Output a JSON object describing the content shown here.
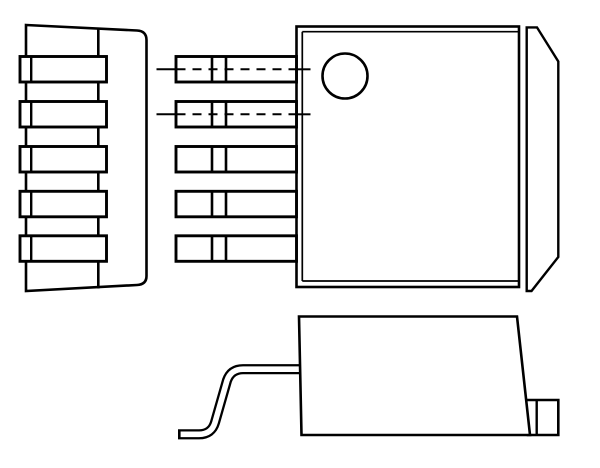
{
  "page": {
    "background": "#ffffff"
  },
  "diagram": {
    "kind": "technical-line-drawing",
    "subject": "Three-view mechanical outline drawing of a 5-lead surface-mount power package (D2PAK / TO-263 style) with mounting tab and pin-1 indicator circle",
    "lead_count": 5,
    "canvas": {
      "width": 600,
      "height": 468
    },
    "style": {
      "stroke": "#000000",
      "stroke_width": 2.6,
      "fill": "none",
      "background": "#ffffff"
    },
    "views": [
      {
        "name": "top-view",
        "shapes": [
          {
            "name": "package-body-outline",
            "type": "rect",
            "attrs": {
              "x": 296.5,
              "y": 26.5,
              "width": 222.5,
              "height": 260.5,
              "fill": "#ffffff",
              "stroke-width": 2.6
            }
          },
          {
            "name": "mold-line-left",
            "type": "line",
            "attrs": {
              "x1": 302.3,
              "y1": 31.7,
              "x2": 302.3,
              "y2": 281,
              "stroke-width": 1.7
            }
          },
          {
            "name": "mold-line-top",
            "type": "line",
            "attrs": {
              "x1": 302.3,
              "y1": 31.7,
              "x2": 519,
              "y2": 31.7,
              "stroke-width": 1.7
            }
          },
          {
            "name": "mold-line-bottom",
            "type": "line",
            "attrs": {
              "x1": 302.3,
              "y1": 281,
              "x2": 519,
              "y2": 281,
              "stroke-width": 1.7
            }
          },
          {
            "name": "mounting-tab-outline",
            "type": "path",
            "attrs": {
              "d": "M 526.7 27.4 L 537 27.4 L 558.3 61.5 L 558.3 257 L 531.5 291 L 526.7 291 Z",
              "fill": "#ffffff",
              "stroke-width": 2.4
            }
          },
          {
            "name": "pin1-indicator-circle",
            "type": "circle",
            "attrs": {
              "cx": 345,
              "cy": 76,
              "r": 22.5,
              "fill": "none",
              "stroke-width": 2.6
            }
          }
        ]
      },
      {
        "name": "lead-detail-view",
        "shapes": [
          {
            "name": "lead-1-outline",
            "type": "rect",
            "attrs": {
              "x": 176,
              "y": 56.5,
              "width": 120.5,
              "height": 25.5,
              "fill": "#ffffff",
              "stroke-width": 2.9
            }
          },
          {
            "name": "lead-1-bend-line-a",
            "type": "line",
            "attrs": {
              "x1": 212,
              "y1": 56.5,
              "x2": 212,
              "y2": 82,
              "stroke-width": 2.6
            }
          },
          {
            "name": "lead-1-bend-line-b",
            "type": "line",
            "attrs": {
              "x1": 226,
              "y1": 56.5,
              "x2": 226,
              "y2": 82,
              "stroke-width": 2.6
            }
          },
          {
            "name": "lead-2-outline",
            "type": "rect",
            "attrs": {
              "x": 176,
              "y": 101.5,
              "width": 120.5,
              "height": 25.5,
              "fill": "#ffffff",
              "stroke-width": 2.9
            }
          },
          {
            "name": "lead-2-bend-line-a",
            "type": "line",
            "attrs": {
              "x1": 212,
              "y1": 101.5,
              "x2": 212,
              "y2": 127,
              "stroke-width": 2.6
            }
          },
          {
            "name": "lead-2-bend-line-b",
            "type": "line",
            "attrs": {
              "x1": 226,
              "y1": 101.5,
              "x2": 226,
              "y2": 127,
              "stroke-width": 2.6
            }
          },
          {
            "name": "lead-3-outline",
            "type": "rect",
            "attrs": {
              "x": 176,
              "y": 146.5,
              "width": 120.5,
              "height": 25.5,
              "fill": "#ffffff",
              "stroke-width": 2.9
            }
          },
          {
            "name": "lead-3-bend-line-a",
            "type": "line",
            "attrs": {
              "x1": 212,
              "y1": 146.5,
              "x2": 212,
              "y2": 172,
              "stroke-width": 2.6
            }
          },
          {
            "name": "lead-3-bend-line-b",
            "type": "line",
            "attrs": {
              "x1": 226,
              "y1": 146.5,
              "x2": 226,
              "y2": 172,
              "stroke-width": 2.6
            }
          },
          {
            "name": "lead-4-outline",
            "type": "rect",
            "attrs": {
              "x": 176,
              "y": 191.3,
              "width": 120.5,
              "height": 25.5,
              "fill": "#ffffff",
              "stroke-width": 2.9
            }
          },
          {
            "name": "lead-4-bend-line-a",
            "type": "line",
            "attrs": {
              "x1": 212,
              "y1": 191.3,
              "x2": 212,
              "y2": 216.8,
              "stroke-width": 2.6
            }
          },
          {
            "name": "lead-4-bend-line-b",
            "type": "line",
            "attrs": {
              "x1": 226,
              "y1": 191.3,
              "x2": 226,
              "y2": 216.8,
              "stroke-width": 2.6
            }
          },
          {
            "name": "lead-5-outline",
            "type": "rect",
            "attrs": {
              "x": 176,
              "y": 235.8,
              "width": 120.5,
              "height": 25.5,
              "fill": "#ffffff",
              "stroke-width": 2.9
            }
          },
          {
            "name": "lead-5-bend-line-a",
            "type": "line",
            "attrs": {
              "x1": 212,
              "y1": 235.8,
              "x2": 212,
              "y2": 261.3,
              "stroke-width": 2.6
            }
          },
          {
            "name": "lead-5-bend-line-b",
            "type": "line",
            "attrs": {
              "x1": 226,
              "y1": 235.8,
              "x2": 226,
              "y2": 261.3,
              "stroke-width": 2.6
            }
          },
          {
            "name": "lead-1-centerline-solid-left",
            "type": "line",
            "attrs": {
              "x1": 156.5,
              "y1": 69.3,
              "x2": 176.5,
              "y2": 69.3,
              "stroke-width": 2
            }
          },
          {
            "name": "lead-1-centerline-dashed",
            "type": "line",
            "attrs": {
              "x1": 176.5,
              "y1": 69.3,
              "x2": 296,
              "y2": 69.3,
              "stroke-width": 2,
              "stroke-dasharray": "9 7"
            }
          },
          {
            "name": "lead-1-centerline-solid-right",
            "type": "line",
            "attrs": {
              "x1": 296,
              "y1": 69.3,
              "x2": 310.5,
              "y2": 69.3,
              "stroke-width": 2
            }
          },
          {
            "name": "lead-2-centerline-solid-left",
            "type": "line",
            "attrs": {
              "x1": 156.5,
              "y1": 114.3,
              "x2": 176.5,
              "y2": 114.3,
              "stroke-width": 2
            }
          },
          {
            "name": "lead-2-centerline-dashed",
            "type": "line",
            "attrs": {
              "x1": 176.5,
              "y1": 114.3,
              "x2": 296,
              "y2": 114.3,
              "stroke-width": 2,
              "stroke-dasharray": "9 7"
            }
          },
          {
            "name": "lead-2-centerline-solid-right",
            "type": "line",
            "attrs": {
              "x1": 296,
              "y1": 114.3,
              "x2": 310.5,
              "y2": 114.3,
              "stroke-width": 2
            }
          }
        ]
      },
      {
        "name": "front-view",
        "shapes": [
          {
            "name": "package-body-outline",
            "type": "path",
            "attrs": {
              "d": "M 26 25 L 137 30.5 Q 146.5 31 146.5 40 L 146.5 276 Q 146.5 284.5 137 285 L 26 291 Z",
              "fill": "#ffffff",
              "stroke-width": 2.6
            }
          },
          {
            "name": "body-edge-line",
            "type": "line",
            "attrs": {
              "x1": 98.3,
              "y1": 28.5,
              "x2": 98.3,
              "y2": 288.5,
              "stroke-width": 2.6
            }
          },
          {
            "name": "pin-1-outline",
            "type": "rect",
            "attrs": {
              "x": 20,
              "y": 56.5,
              "width": 86.5,
              "height": 25.5,
              "fill": "#ffffff",
              "stroke-width": 2.9
            }
          },
          {
            "name": "pin-1-edge-line",
            "type": "line",
            "attrs": {
              "x1": 31.2,
              "y1": 56.5,
              "x2": 31.2,
              "y2": 82,
              "stroke-width": 2.4
            }
          },
          {
            "name": "pin-2-outline",
            "type": "rect",
            "attrs": {
              "x": 20,
              "y": 101.5,
              "width": 86.5,
              "height": 25.5,
              "fill": "#ffffff",
              "stroke-width": 2.9
            }
          },
          {
            "name": "pin-2-edge-line",
            "type": "line",
            "attrs": {
              "x1": 31.2,
              "y1": 101.5,
              "x2": 31.2,
              "y2": 127,
              "stroke-width": 2.4
            }
          },
          {
            "name": "pin-3-outline",
            "type": "rect",
            "attrs": {
              "x": 20,
              "y": 146.5,
              "width": 86.5,
              "height": 25.5,
              "fill": "#ffffff",
              "stroke-width": 2.9
            }
          },
          {
            "name": "pin-3-edge-line",
            "type": "line",
            "attrs": {
              "x1": 31.2,
              "y1": 146.5,
              "x2": 31.2,
              "y2": 172,
              "stroke-width": 2.4
            }
          },
          {
            "name": "pin-4-outline",
            "type": "rect",
            "attrs": {
              "x": 20,
              "y": 191.3,
              "width": 86.5,
              "height": 25.5,
              "fill": "#ffffff",
              "stroke-width": 2.9
            }
          },
          {
            "name": "pin-4-edge-line",
            "type": "line",
            "attrs": {
              "x1": 31.2,
              "y1": 191.3,
              "x2": 31.2,
              "y2": 216.8,
              "stroke-width": 2.4
            }
          },
          {
            "name": "pin-5-outline",
            "type": "rect",
            "attrs": {
              "x": 20,
              "y": 235.8,
              "width": 86.5,
              "height": 25.5,
              "fill": "#ffffff",
              "stroke-width": 2.9
            }
          },
          {
            "name": "pin-5-edge-line",
            "type": "line",
            "attrs": {
              "x1": 31.2,
              "y1": 235.8,
              "x2": 31.2,
              "y2": 261.3,
              "stroke-width": 2.4
            }
          }
        ]
      },
      {
        "name": "side-view",
        "shapes": [
          {
            "name": "gullwing-lead-outline",
            "type": "path",
            "attrs": {
              "d": "M 300 369.2 L 243 369.2 Q 231 369.2 227 380.5 L 215 422.5 Q 211.5 434.3 199 434.3 L 178 434.3",
              "fill": "none",
              "stroke-width": 10.2,
              "stroke-linejoin": "round",
              "stroke-linecap": "butt"
            }
          },
          {
            "name": "gullwing-lead-core",
            "type": "path",
            "attrs": {
              "d": "M 303.5 369.2 L 243 369.2 Q 231 369.2 227 380.5 L 215 422.5 Q 211.5 434.3 199 434.3 L 180.6 434.3",
              "fill": "none",
              "stroke": "#ffffff",
              "stroke-width": 5.6,
              "stroke-linejoin": "round",
              "stroke-linecap": "butt"
            }
          },
          {
            "name": "mounting-tab-outline",
            "type": "path",
            "attrs": {
              "d": "M 526.7 400 L 558.3 400 L 558.3 435 L 526.7 435",
              "fill": "#ffffff",
              "stroke-width": 2.6
            }
          },
          {
            "name": "tab-bend-line",
            "type": "line",
            "attrs": {
              "x1": 536.7,
              "y1": 400,
              "x2": 536.7,
              "y2": 435,
              "stroke-width": 2.4
            }
          },
          {
            "name": "package-body-outline",
            "type": "path",
            "attrs": {
              "d": "M 299 316.5 L 517 316.5 L 530 435 L 301.5 435 Z",
              "fill": "#ffffff",
              "stroke-width": 2.6
            }
          }
        ]
      }
    ]
  }
}
